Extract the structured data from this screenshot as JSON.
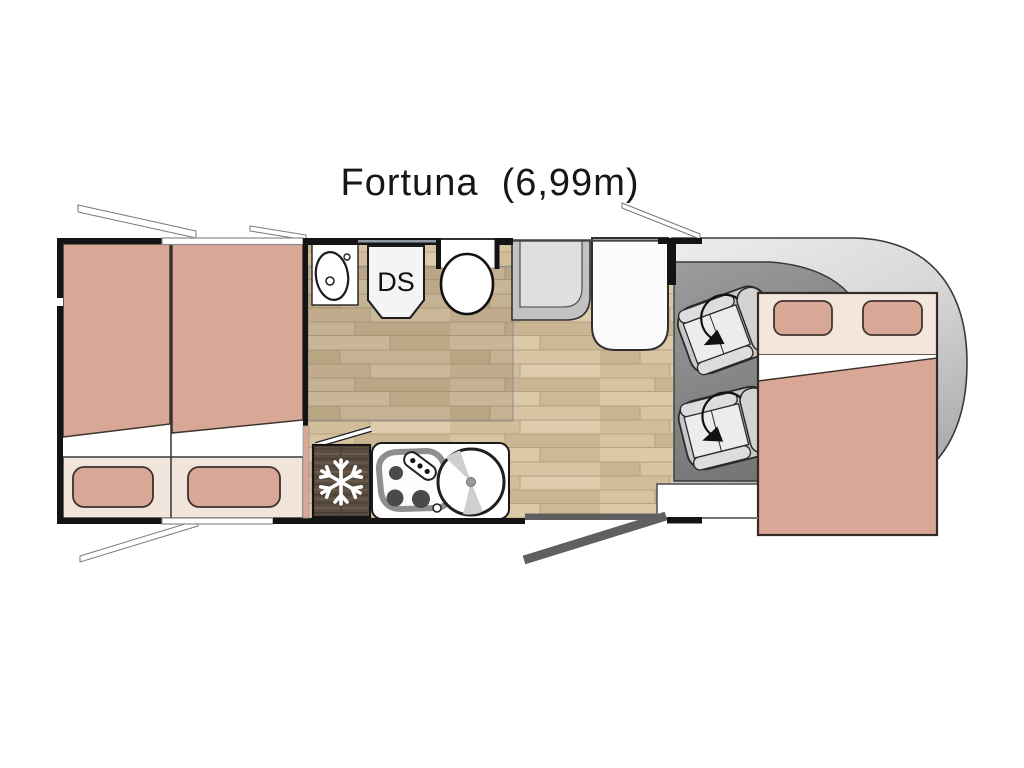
{
  "title": "Fortuna  (6,99m)",
  "plan": {
    "model_name": "Fortuna",
    "length": "6,99m",
    "shower_label": "DS",
    "orientation": "side view from above, vehicle cab (front) on the right, rear bedroom on the left",
    "features": [
      "rear twin single beds (salmon mattresses)",
      "two under-bed storage drawers / pillows panel",
      "bathroom washbasin on counter",
      "shower cubicle labelled DS",
      "toilet in wall niche",
      "fridge with snowflake icon (dark wood front)",
      "three-burner gas hob with control knobs",
      "round kitchen sink with tap",
      "bathroom door shown open (white diagonal)",
      "dinette bench seat",
      "white table",
      "two swivelling cab seats with rotation arrows",
      "drop-down front double bed with two pillows",
      "entry step",
      "open entry door (dark grey diagonal)",
      "four open window flaps",
      "wood-plank living floor",
      "grey cab floor",
      "rounded vehicle nose"
    ]
  },
  "colors": {
    "bed_mattress": "#D9A795",
    "bed_trim_cream": "#F2E6DD",
    "wood_floor": "#D5C1A0",
    "bathroom_floor_tint": "#C6B291",
    "cab_floor": "#8A8A8A",
    "vehicle_nose": "#D9D9D9",
    "fridge_wood": "#594C40",
    "wall": "#141414",
    "entry_door": "#606060",
    "background": "#FFFFFF"
  }
}
